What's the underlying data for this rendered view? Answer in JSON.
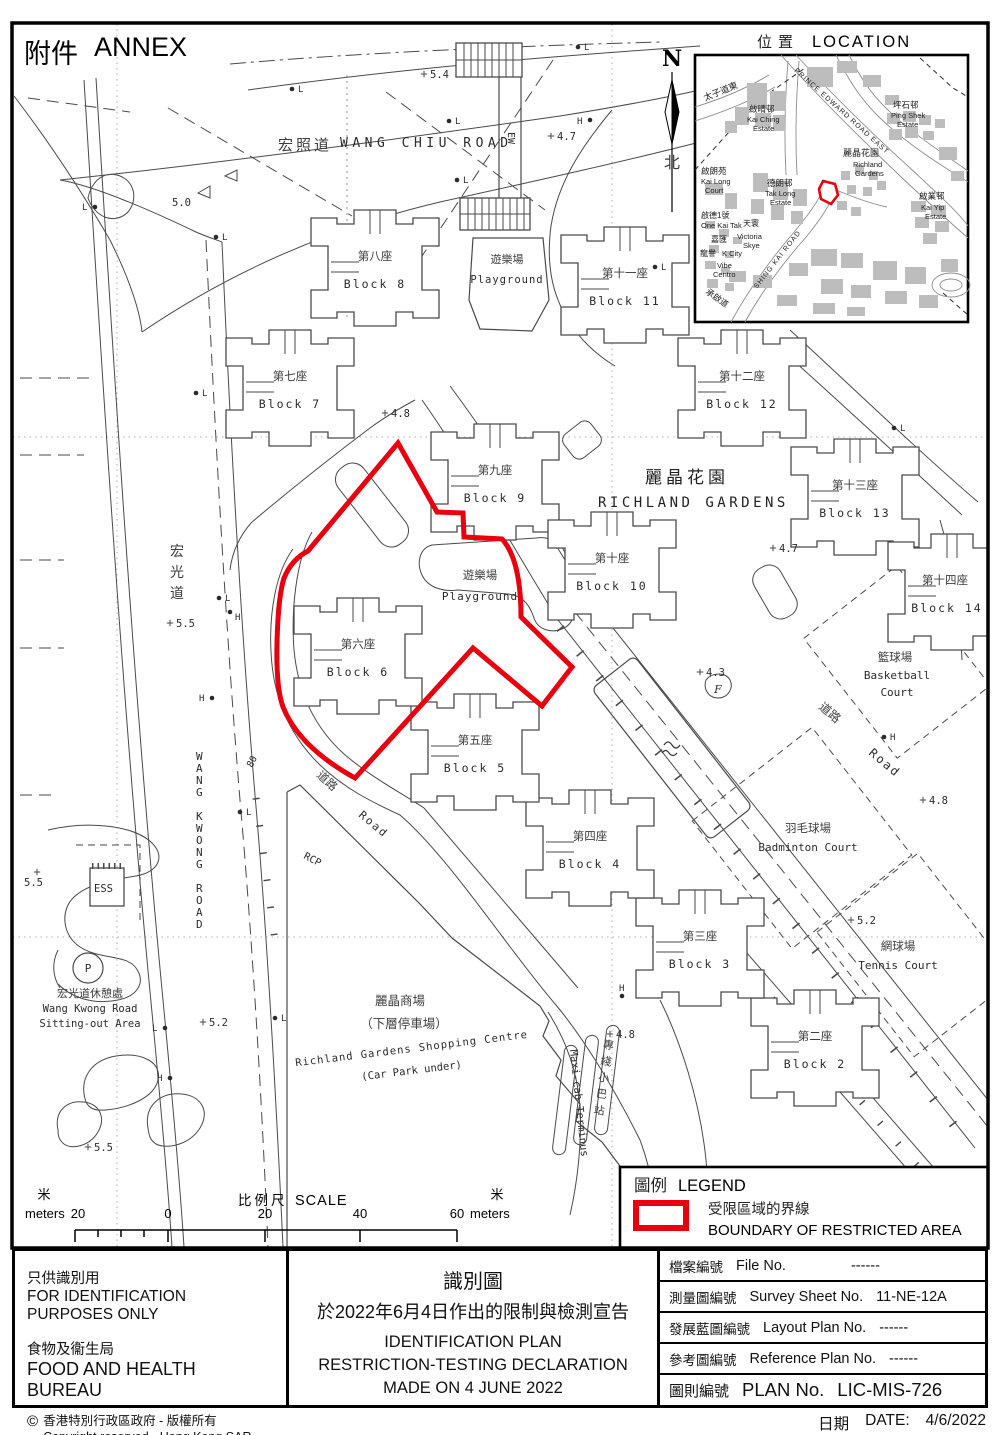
{
  "colors": {
    "boundary_red": "#E8000F",
    "map_line": "#4A4A4A",
    "inset_building": "#BDBDBD"
  },
  "annex": {
    "zh": "附件",
    "en": "ANNEX"
  },
  "north": {
    "n": "N",
    "zh": "北"
  },
  "location_inset": {
    "title_zh": "位置",
    "title_en": "LOCATION",
    "labels": {
      "tsz_road": "太子道東",
      "pere": "PRINCE EDWARD ROAD EAST",
      "ping_shek_zh": "坪石邨",
      "ping_shek_en1": "Ping Shek",
      "ping_shek_en2": "Estate",
      "kai_ching_zh": "啟晴邨",
      "kai_ching_en1": "Kai Ching",
      "kai_ching_en2": "Estate",
      "kai_long_zh": "啟朗苑",
      "kai_long_en1": "Kai Long",
      "kai_long_en2": "Court",
      "tak_long_zh": "德朗邨",
      "tak_long_en1": "Tak Long",
      "tak_long_en2": "Estate",
      "one_kai_tak_zh": "啟德1號",
      "one_kai_tak_en": "One Kai Tak",
      "tin_wan": "天寰",
      "victoria_zh": "嘉匯",
      "victoria_en1": "Victoria",
      "victoria_en2": "Skye",
      "k_city_zh": "龍譽",
      "k_city_en": "K City",
      "vibe_en1": "Vibe",
      "vibe_en2": "Centro",
      "richland_zh": "麗晶花園",
      "richland_en1": "Richland",
      "richland_en2": "Gardens",
      "kai_yip_zh": "啟業邨",
      "kai_yip_en1": "Kai Yip",
      "kai_yip_en2": "Estate",
      "shing_kai": "SHING KAI ROAD",
      "shing_kai_zh": "承啟道"
    }
  },
  "map": {
    "roads": {
      "wang_chiu_zh": "宏照道",
      "wang_chiu_en": "WANG CHIU ROAD",
      "wang_kwong_zh": "宏光道",
      "wang_kwong_en": "WANG KWONG ROAD",
      "road_zh_a": "道路",
      "road_en_a": "Road",
      "road_zh_b": "道路",
      "road_en_b": "Road",
      "rcp": "RCP",
      "ew": "EW",
      "eighty": "80"
    },
    "estate_zh": "麗晶花園",
    "estate_en": "RICHLAND  GARDENS",
    "blocks": [
      {
        "zh": "第二座",
        "en": "Block 2"
      },
      {
        "zh": "第三座",
        "en": "Block 3"
      },
      {
        "zh": "第四座",
        "en": "Block 4"
      },
      {
        "zh": "第五座",
        "en": "Block 5"
      },
      {
        "zh": "第六座",
        "en": "Block 6"
      },
      {
        "zh": "第七座",
        "en": "Block 7"
      },
      {
        "zh": "第八座",
        "en": "Block 8"
      },
      {
        "zh": "第九座",
        "en": "Block 9"
      },
      {
        "zh": "第十座",
        "en": "Block 10"
      },
      {
        "zh": "第十一座",
        "en": "Block 11"
      },
      {
        "zh": "第十二座",
        "en": "Block 12"
      },
      {
        "zh": "第十三座",
        "en": "Block 13"
      },
      {
        "zh": "第十四座",
        "en": "Block 14"
      }
    ],
    "facilities": {
      "playground_zh": "遊樂場",
      "playground_en": "Playground",
      "playground2_zh": "遊樂場",
      "playground2_en": "Playground",
      "basketball_zh": "籃球場",
      "basketball_en1": "Basketball",
      "basketball_en2": "Court",
      "badminton_zh": "羽毛球場",
      "badminton_en": "Badminton Court",
      "tennis_zh": "網球場",
      "tennis_en": "Tennis Court",
      "shopping_zh1": "麗晶商場",
      "shopping_zh2": "（下層停車場）",
      "shopping_en1": "Richland Gardens Shopping Centre",
      "shopping_en2": "(Car Park under)",
      "maxicab_zh": "專綫小巴站",
      "maxicab_en": "Maxi-cab Terminus",
      "sitting_zh": "宏光道休憩處",
      "sitting_en1": "Wang Kwong Road",
      "sitting_en2": "Sitting-out Area",
      "ess": "ESS",
      "p": "P",
      "f": "F"
    },
    "spots": [
      "5.4",
      "4.7",
      "5.0",
      "4.8",
      "4.7",
      "4.3",
      "4.8",
      "5.5",
      "5.5",
      "5.2",
      "4.8",
      "5.5",
      "5.2"
    ],
    "markers": [
      "L",
      "L",
      "L",
      "H",
      "L",
      "L",
      "L",
      "L",
      "L",
      "L",
      "H",
      "H",
      "L",
      "L",
      "H",
      "L",
      "L",
      "H",
      "H"
    ]
  },
  "legend": {
    "zh": "圖例",
    "en": "LEGEND",
    "item_zh": "受限區域的界線",
    "item_en": "BOUNDARY OF RESTRICTED AREA"
  },
  "scale": {
    "zh": "比例尺",
    "en": "SCALE",
    "m_left": "米",
    "m_right": "米",
    "meters_left": "meters",
    "meters_right": "meters",
    "v20l": "20",
    "v0": "0",
    "v20": "20",
    "v40": "40",
    "v60": "60"
  },
  "footer": {
    "left": {
      "zh1": "只供識別用",
      "en1": "FOR IDENTIFICATION PURPOSES ONLY",
      "zh2": "食物及衞生局",
      "en2": "FOOD AND HEALTH BUREAU",
      "copy_sym": "©",
      "copy_zh": "香港特別行政區政府 - 版權所有",
      "copy_en": "Copyright reserved - Hong Kong SAR Government"
    },
    "center": {
      "t1": "識別圖",
      "t2": "於2022年6月4日作出的限制與檢測宣告",
      "t3": "IDENTIFICATION PLAN",
      "t4": "RESTRICTION-TESTING DECLARATION",
      "t5": "MADE ON 4 JUNE 2022"
    },
    "right": {
      "rows": [
        {
          "zh": "檔案編號",
          "en": "File  No.",
          "val": "------"
        },
        {
          "zh": "測量圖編號",
          "en": "Survey  Sheet  No.",
          "val": "11-NE-12A"
        },
        {
          "zh": "發展藍圖編號",
          "en": "Layout  Plan  No.",
          "val": "------"
        },
        {
          "zh": "參考圖編號",
          "en": "Reference  Plan  No.",
          "val": "------"
        },
        {
          "zh": "圖則編號",
          "en": "PLAN  No.",
          "val": "LIC-MIS-726"
        }
      ]
    },
    "date": {
      "zh": "日期",
      "en": "DATE:",
      "val": "4/6/2022"
    }
  }
}
